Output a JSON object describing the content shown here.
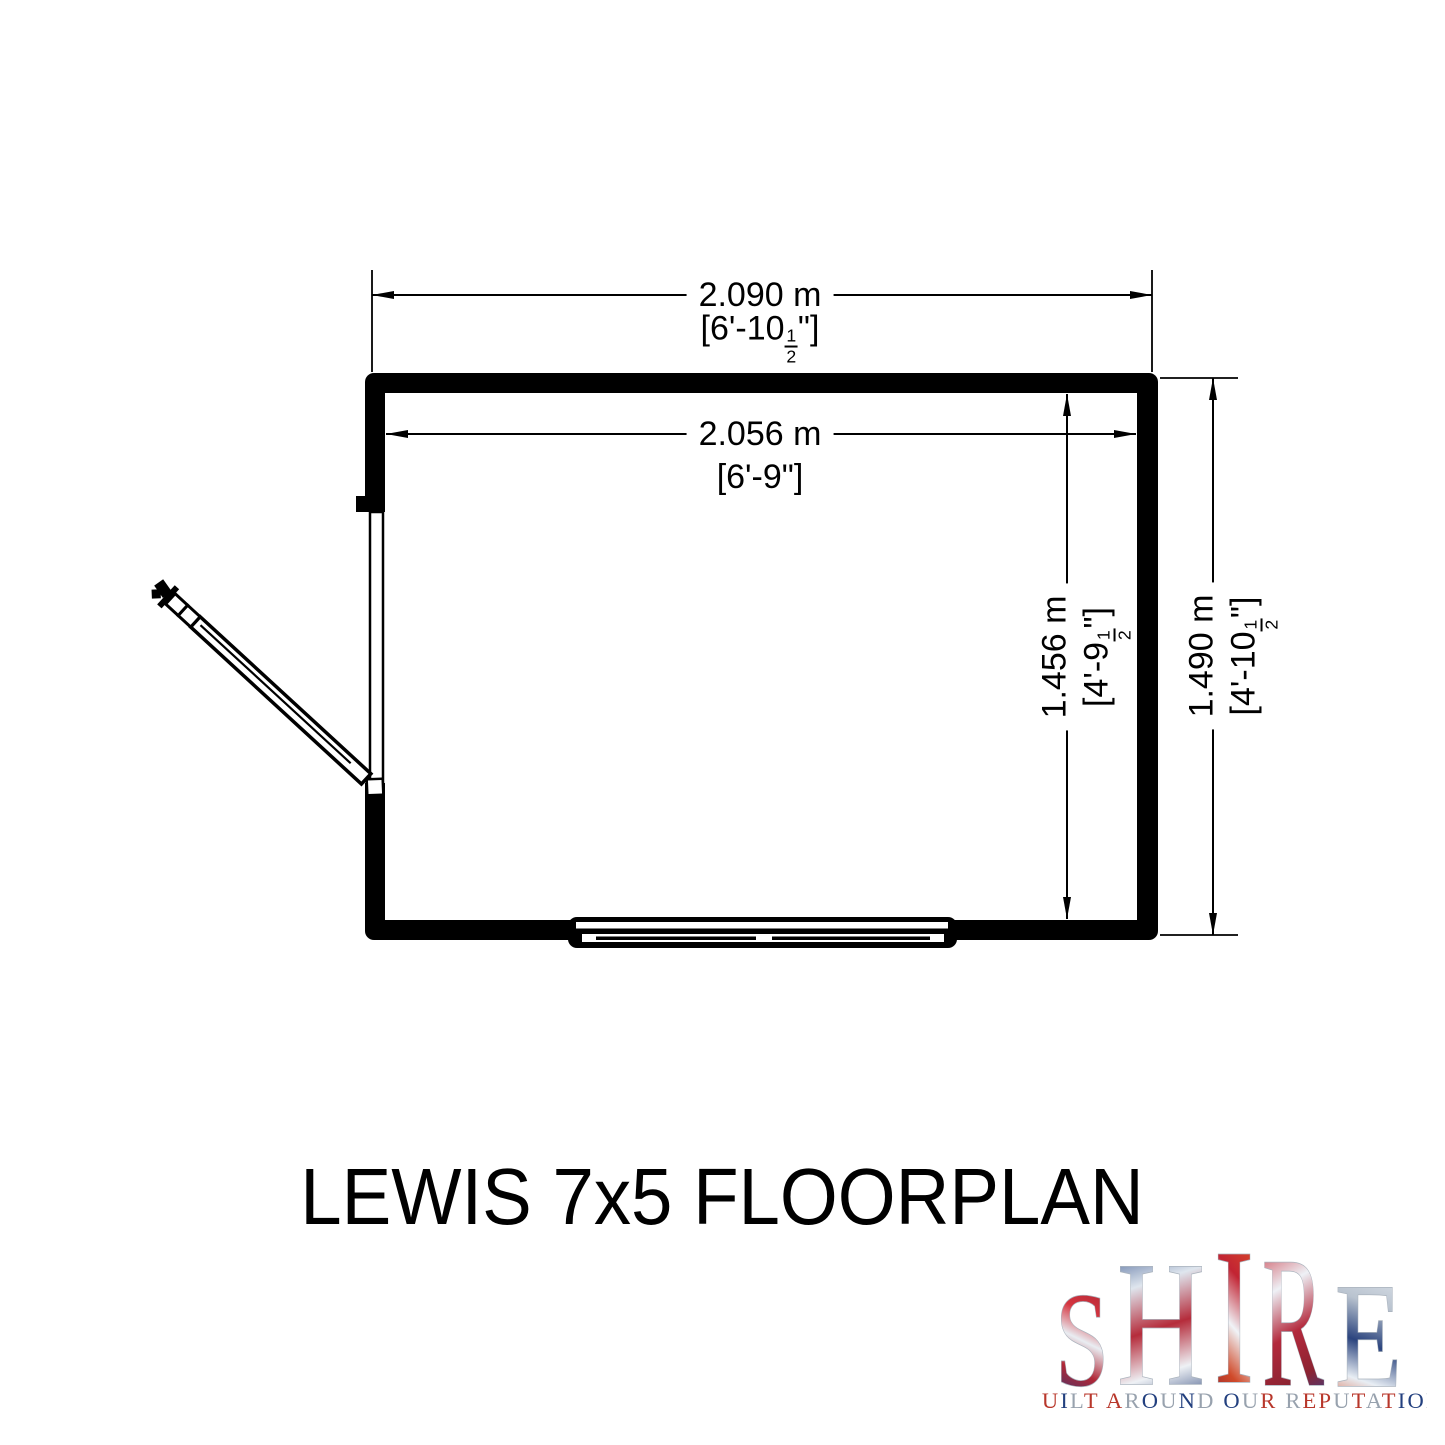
{
  "page": {
    "background": "#ffffff"
  },
  "floorplan": {
    "title": "LEWIS 7x5 FLOORPLAN",
    "dims": {
      "top_outer": {
        "metric": "2.090 m",
        "imp_pre": "[6'-10",
        "imp_num": "1",
        "imp_den": "2",
        "imp_suf": "\"]"
      },
      "top_inner": {
        "metric": "2.056 m",
        "imp_pre": "[6'-9",
        "imp_num": "",
        "imp_den": "",
        "imp_suf": "\"]"
      },
      "side_outer": {
        "metric": "1.490 m",
        "imp_pre": "[4'-10",
        "imp_num": "1",
        "imp_den": "2",
        "imp_suf": "\"]"
      },
      "side_inner": {
        "metric": "1.456 m",
        "imp_pre": "[4'-9",
        "imp_num": "1",
        "imp_den": "2",
        "imp_suf": "\"]"
      }
    },
    "features": {
      "door": "open-door-left-wall",
      "window": "window-bottom-wall"
    },
    "line_color": "#000000"
  },
  "logo": {
    "brand": "SHIRE",
    "letters": [
      "S",
      "H",
      "I",
      "R",
      "E"
    ],
    "tagline": "BUILT AROUND OUR REPUTATION",
    "brand_colors": {
      "red": "#b8372b",
      "blue": "#23407f",
      "silver": "#98a2ae"
    },
    "tagline_letter_colors": [
      "#98a2ae",
      "#b8372b",
      "#23407f",
      "#98a2ae",
      "#b8372b",
      null,
      "#b8372b",
      "#98a2ae",
      "#23407f",
      "#98a2ae",
      "#23407f",
      "#98a2ae",
      null,
      "#23407f",
      "#98a2ae",
      "#b8372b",
      null,
      "#98a2ae",
      "#b8372b",
      "#b8372b",
      "#98a2ae",
      "#b8372b",
      "#98a2ae",
      "#b8372b",
      "#23407f",
      "#23407f",
      "#98a2ae"
    ]
  }
}
